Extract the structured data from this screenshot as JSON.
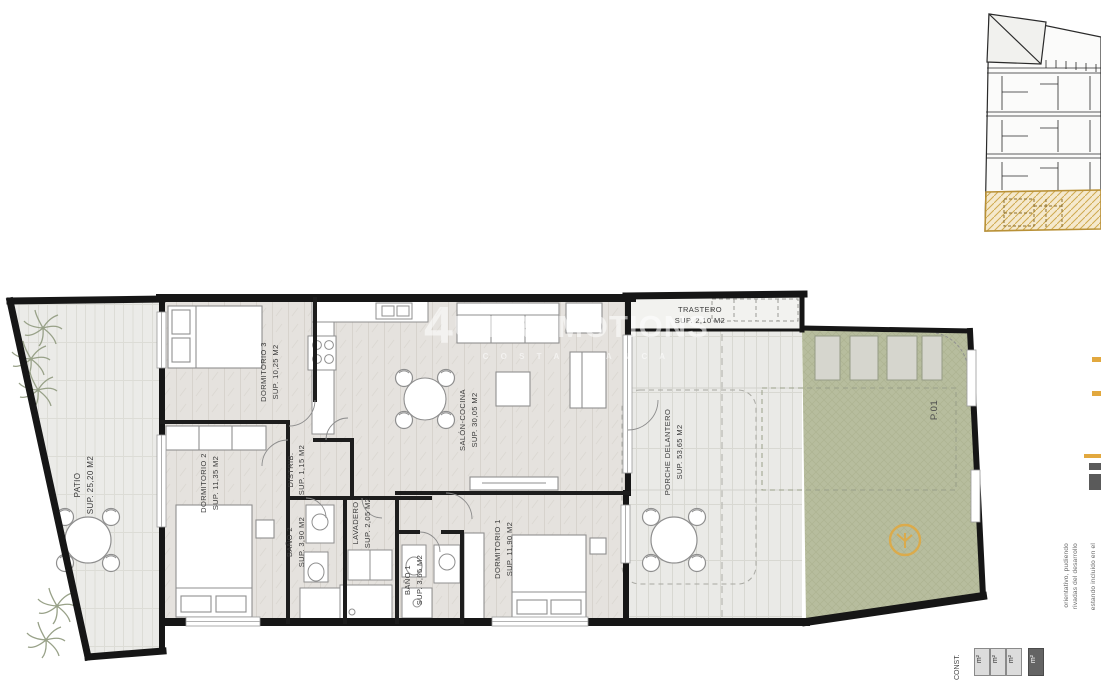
{
  "plan": {
    "plot_label": "P.01",
    "rooms": [
      {
        "id": "patio",
        "name": "PATIO",
        "area": "SUP. 25,20 M2"
      },
      {
        "id": "dormitorio3",
        "name": "DORMITORIO 3",
        "area": "SUP. 10,25 M2"
      },
      {
        "id": "dormitorio2",
        "name": "DORMITORIO 2",
        "area": "SUP. 11,35 M2"
      },
      {
        "id": "distrib",
        "name": "DISTRIB.",
        "area": "SUP. 1,15 M2"
      },
      {
        "id": "bano2",
        "name": "BAÑO 2",
        "area": "SUP. 3,90 M2"
      },
      {
        "id": "lavadero",
        "name": "LAVADERO",
        "area": "SUP. 2,05 M2"
      },
      {
        "id": "bano1",
        "name": "BAÑO 1",
        "area": "SUP. 3,65 M2"
      },
      {
        "id": "dormitorio1",
        "name": "DORMITORIO 1",
        "area": "SUP. 11,90 M2"
      },
      {
        "id": "salon",
        "name": "SALÓN-COCINA",
        "area": "SUP. 30,05 M2"
      },
      {
        "id": "trastero",
        "name": "TRASTERO",
        "area": "SUP. 2,10 M2"
      },
      {
        "id": "porche",
        "name": "PORCHE DELANTERO",
        "area": "SUP. 53,65 M2"
      }
    ]
  },
  "watermark": {
    "line1_prefix": "4",
    "line1_rest": "U PROMOTIONS",
    "line2": "C O S T A   B L A N C A"
  },
  "legend_table": {
    "header": "CONST.",
    "cells": [
      "m²",
      "m²",
      "m²"
    ],
    "total": "m²"
  },
  "disclaimer_fragments": {
    "f1": "orientativo, pudiendo",
    "f2": "rivadas del desarrollo",
    "f3": "estando incluido en el"
  },
  "colors": {
    "wall": "#161616",
    "garden_green": "#b7bd9e",
    "highlight_yellow": "#f5e9cd",
    "hatch_gold": "#cfa94e",
    "accent_orange": "#e2a83e"
  }
}
